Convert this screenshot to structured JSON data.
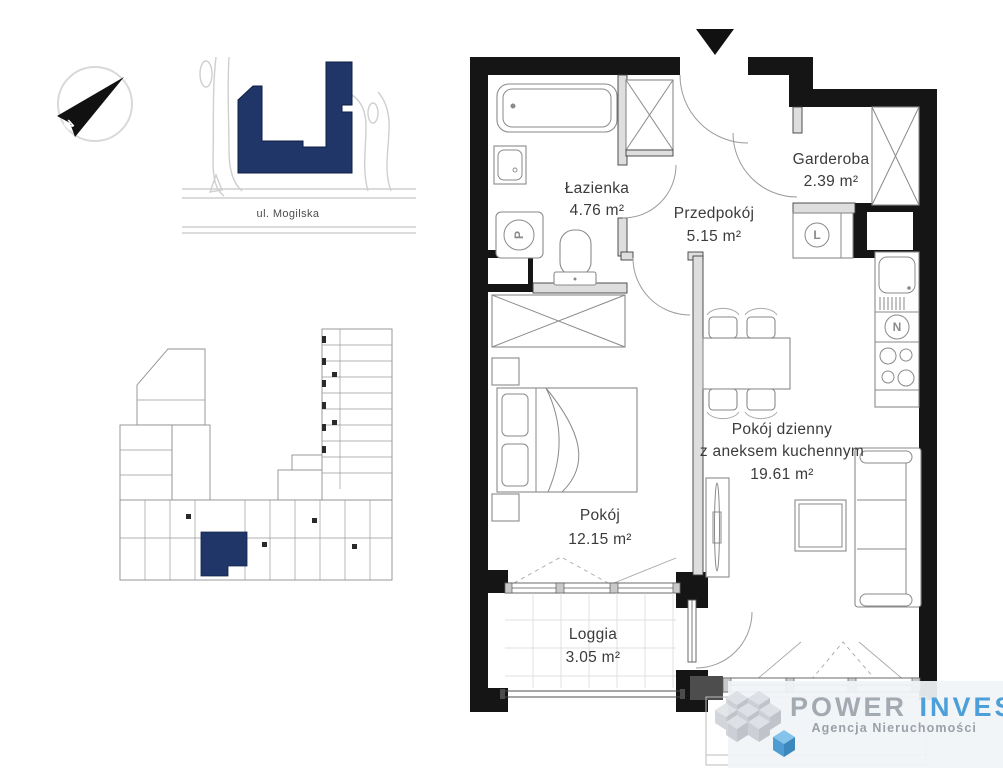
{
  "page": {
    "background": "#ffffff"
  },
  "compass": {
    "label": "N"
  },
  "site_map": {
    "street_label": "ul. Mogilska",
    "building_color": "#203668"
  },
  "overview_plan": {
    "highlight_color": "#203668"
  },
  "floor_plan": {
    "rooms": {
      "lazienka": {
        "name": "Łazienka",
        "area": "4.76 m²"
      },
      "przedpokoj": {
        "name": "Przedpokój",
        "area": "5.15 m²"
      },
      "garderoba": {
        "name": "Garderoba",
        "area": "2.39 m²"
      },
      "pokoj_dzienny": {
        "name_line1": "Pokój dzienny",
        "name_line2": "z aneksem kuchennym",
        "area": "19.61 m²"
      },
      "pokoj": {
        "name": "Pokój",
        "area": "12.15 m²"
      },
      "loggia": {
        "name": "Loggia",
        "area": "3.05 m²"
      }
    },
    "appliances": {
      "washing_machine": {
        "symbol": "P"
      },
      "fridge": {
        "symbol": "L"
      },
      "dishwasher": {
        "symbol": "N"
      }
    }
  },
  "logo": {
    "brand_word1": "POWER",
    "brand_word2": "INVEST",
    "subtitle": "Agencja Nieruchomości",
    "word1_color": "#9aa0a8",
    "word2_color": "#4c9fd8"
  }
}
